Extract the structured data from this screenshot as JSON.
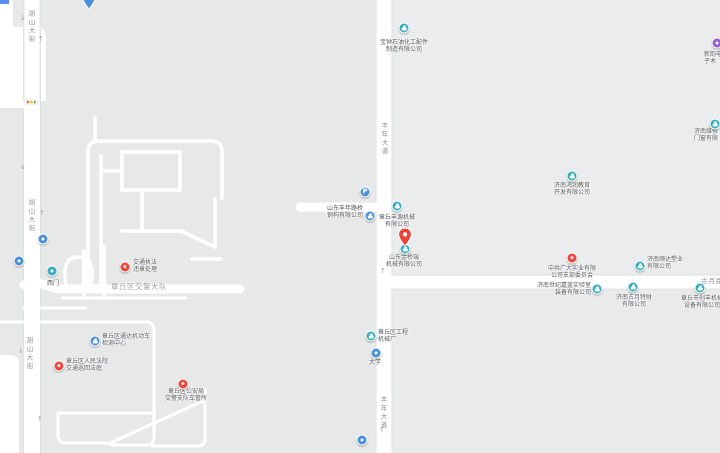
{
  "map": {
    "colors": {
      "background": "#e7e8e8",
      "block_light": "#ebeced",
      "road": "#ffffff",
      "poi_teal": "#35aec2",
      "poi_blue": "#4a90d9",
      "poi_red": "#e8453c",
      "poi_purple": "#9a5bd2",
      "pin_red": "#ea4335",
      "chip_blue": "#5b8def",
      "tl_red": "#ef5350",
      "tl_amber": "#f9c440",
      "tl_green": "#5bb661",
      "label_text": "#56585b",
      "road_label_text": "#8d9194"
    },
    "pois": [
      {
        "id": "edge-chip",
        "icon": "chip",
        "color": "chip_blue",
        "ix": 0,
        "iy": 0
      },
      {
        "id": "cutoff-top-pin",
        "icon": "pin-cut",
        "color": "poi_blue",
        "ix": 89,
        "iy": -9
      },
      {
        "id": "baozhong-shiyou",
        "icon": "company",
        "color": "poi_teal",
        "ix": 404,
        "iy": 28,
        "lines": [
          "宝钟石油化工配件",
          "制造有限公司"
        ],
        "align": "center",
        "lx": 404,
        "ly": 40
      },
      {
        "id": "xinyun-dianzi",
        "icon": "dot",
        "color": "poi_purple",
        "ix": 717,
        "iy": 43,
        "lines": [
          "新韵电",
          "子木"
        ],
        "align": "left",
        "lx": 704,
        "ly": 52
      },
      {
        "id": "jinan-menchuang",
        "icon": "company",
        "color": "poi_teal",
        "ix": 715,
        "iy": 124,
        "lines": [
          "济南维修",
          "门窗有限"
        ],
        "align": "left",
        "lx": 694,
        "ly": 129
      },
      {
        "id": "jinan-hongrun",
        "icon": "company",
        "color": "poi_teal",
        "ix": 572,
        "iy": 176,
        "lines": [
          "济南鸿润教育",
          "开发有限公司"
        ],
        "align": "center",
        "lx": 572,
        "ly": 183
      },
      {
        "id": "parking",
        "icon": "p",
        "color": "poi_blue",
        "glyph": "P",
        "ix": 365,
        "iy": 192
      },
      {
        "id": "fengnian-luqiao",
        "icon": "company",
        "color": "poi_blue",
        "ix": 370,
        "iy": 216,
        "lines": [
          "山东丰年路桥",
          "钢构有限公司"
        ],
        "align": "right",
        "lx": 363,
        "ly": 206
      },
      {
        "id": "fengyuan-jixie",
        "icon": "company",
        "color": "poi_teal",
        "ix": 397,
        "iy": 206,
        "lines": [
          "章丘丰源机械",
          "有限公司"
        ],
        "align": "center",
        "lx": 397,
        "ly": 215
      },
      {
        "id": "jinqiaorui-pin",
        "icon": "pin-red",
        "color": "pin_red",
        "ix": 405,
        "iy": 246
      },
      {
        "id": "jinqiaorui",
        "icon": "company",
        "color": "poi_teal",
        "ix": 405,
        "iy": 249,
        "lines": [
          "山东金桥瑞",
          "机械有限公司"
        ],
        "align": "center",
        "lx": 404,
        "ly": 255
      },
      {
        "id": "zhonggong-guangda",
        "icon": "gov",
        "color": "poi_red",
        "glyph": "★",
        "ix": 572,
        "iy": 258,
        "lines": [
          "中共广大实业有限",
          "公司支部委员会"
        ],
        "align": "center",
        "lx": 572,
        "ly": 266
      },
      {
        "id": "shunda-suye",
        "icon": "company",
        "color": "poi_teal",
        "ix": 640,
        "iy": 266,
        "lines": [
          "济南顺达塑业",
          "有限公司"
        ],
        "align": "left",
        "lx": 647,
        "ly": 257
      },
      {
        "id": "shiji-jialan",
        "icon": "company",
        "color": "poi_teal",
        "ix": 597,
        "iy": 289,
        "lines": [
          "济南世纪嘉蓝实验室",
          "装备有限公司"
        ],
        "align": "right",
        "lx": 591,
        "ly": 283
      },
      {
        "id": "guyue-tecai",
        "icon": "company",
        "color": "poi_teal",
        "ix": 633,
        "iy": 287,
        "lines": [
          "济南古月特财",
          "有限公司"
        ],
        "align": "center",
        "lx": 634,
        "ly": 295
      },
      {
        "id": "chuangfeng-jixie",
        "icon": "company",
        "color": "poi_teal",
        "ix": 700,
        "iy": 288,
        "lines": [
          "章丘市创丰机械",
          "设备有限公司"
        ],
        "align": "center",
        "lx": 702,
        "ly": 296
      },
      {
        "id": "jiaotong-zhifa",
        "icon": "gov",
        "color": "poi_red",
        "glyph": "★",
        "ix": 125,
        "iy": 267,
        "lines": [
          "交通执法",
          "违章处理"
        ],
        "align": "left",
        "lx": 133,
        "ly": 260
      },
      {
        "id": "ximen-gate",
        "icon": "gate",
        "color": "poi_teal",
        "ix": 52,
        "iy": 271,
        "lines": [
          "西门"
        ],
        "align": "center",
        "lx": 53,
        "ly": 281
      },
      {
        "id": "bus-stop-1",
        "icon": "dot",
        "color": "poi_blue",
        "ix": 43,
        "iy": 239
      },
      {
        "id": "bus-stop-2",
        "icon": "dot",
        "color": "poi_blue",
        "ix": 19,
        "iy": 261
      },
      {
        "id": "tongda-jiance",
        "icon": "company",
        "color": "poi_blue",
        "ix": 95,
        "iy": 341,
        "lines": [
          "章丘区通达机动车",
          "检测中心"
        ],
        "align": "left",
        "lx": 102,
        "ly": 334
      },
      {
        "id": "renmin-fayuan",
        "icon": "gov",
        "color": "poi_red",
        "glyph": "★",
        "ix": 59,
        "iy": 366,
        "lines": [
          "章丘区人民法院",
          "交通巡回法庭"
        ],
        "align": "left",
        "lx": 66,
        "ly": 359
      },
      {
        "id": "cheguansuo",
        "icon": "gov",
        "color": "poi_red",
        "glyph": "★",
        "ix": 183,
        "iy": 384,
        "lines": [
          "章丘区公安局",
          "交警支队车管所"
        ],
        "align": "center",
        "lx": 186,
        "ly": 389
      },
      {
        "id": "gongcheng-jixiechang",
        "icon": "company",
        "color": "poi_teal",
        "ix": 371,
        "iy": 336,
        "lines": [
          "章丘区工程",
          "机械厂"
        ],
        "align": "left",
        "lx": 378,
        "ly": 330
      },
      {
        "id": "daxue-stop",
        "icon": "dot",
        "color": "poi_blue",
        "ix": 376,
        "iy": 353,
        "lines": [
          "大学"
        ],
        "align": "center",
        "lx": 375,
        "ly": 360
      },
      {
        "id": "bus-stop-3",
        "icon": "dot",
        "color": "poi_blue",
        "ix": 362,
        "iy": 440
      },
      {
        "id": "traffic-light",
        "icon": "traffic",
        "ix": 31,
        "iy": 102
      }
    ],
    "road_labels": [
      {
        "text": "胡山大街",
        "vertical": true,
        "x": 31,
        "y": 10
      },
      {
        "text": "胡山大街",
        "vertical": true,
        "x": 31,
        "y": 199
      },
      {
        "text": "胡山大街",
        "vertical": true,
        "x": 29,
        "y": 337
      },
      {
        "text": "丰年大道",
        "vertical": true,
        "x": 384,
        "y": 122
      },
      {
        "text": "丰年大道",
        "vertical": true,
        "x": 383,
        "y": 396
      },
      {
        "text": "古月路",
        "vertical": false,
        "x": 701,
        "y": 275
      },
      {
        "text": "章丘区交警大队",
        "vertical": false,
        "area": true,
        "x": 111,
        "y": 281
      }
    ],
    "arrows": [
      {
        "glyph": "↓",
        "x": 20,
        "y": 15
      },
      {
        "glyph": "↑",
        "x": 38,
        "y": 36
      },
      {
        "glyph": "↓",
        "x": 20,
        "y": 164
      },
      {
        "glyph": "↑",
        "x": 39,
        "y": 210
      },
      {
        "glyph": "↓",
        "x": 18,
        "y": 348
      },
      {
        "glyph": "↑",
        "x": 37,
        "y": 416
      },
      {
        "glyph": "↑",
        "x": 380,
        "y": 268
      },
      {
        "glyph": "↑",
        "x": 379,
        "y": 427
      }
    ]
  }
}
